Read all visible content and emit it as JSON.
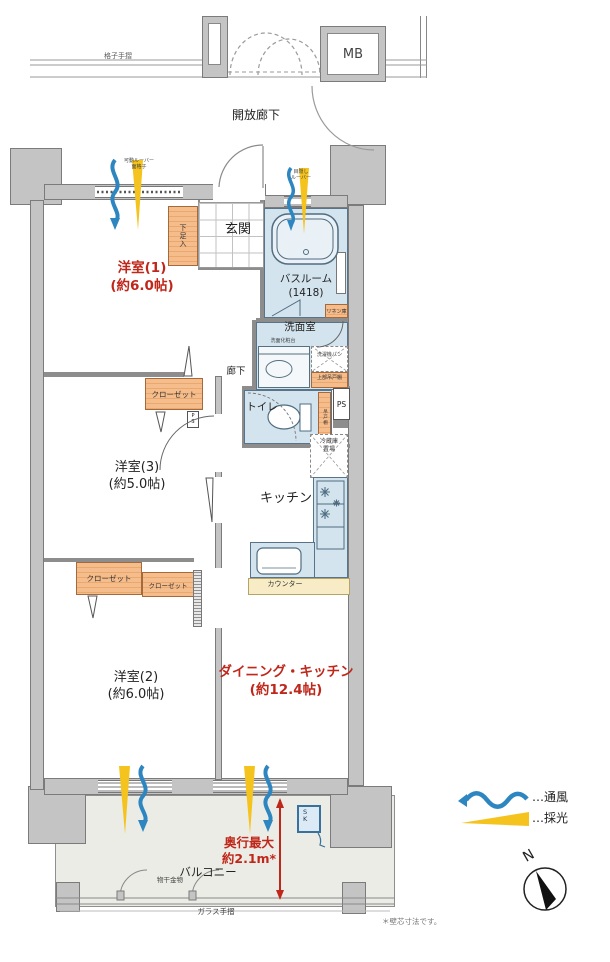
{
  "colors": {
    "wall_gray": "#c4c4c4",
    "wet_blue": "#d3e4ee",
    "cabinet_orange": "#f5bc8c",
    "counter_cream": "#f7ecc6",
    "accent_red": "#c0271b",
    "ventilation_blue": "#2e86c1",
    "daylight_yellow": "#f5c31d"
  },
  "corridor": {
    "handrail": "格子手摺",
    "open_corridor": "開放廊下",
    "meter_box": "MB"
  },
  "rooms": {
    "western1": {
      "name": "洋室(1)",
      "size": "(約6.0帖)"
    },
    "western3": {
      "name": "洋室(3)",
      "size": "(約5.0帖)"
    },
    "western2": {
      "name": "洋室(2)",
      "size": "(約6.0帖)"
    },
    "dining_kitchen": {
      "name": "ダイニング・キッチン",
      "size": "(約12.4帖)"
    },
    "entrance": "玄関",
    "shoe_box": "下足入",
    "bathroom": {
      "name": "バスルーム",
      "size": "(1418)"
    },
    "washroom": "洗面室",
    "vanity": "洗面化粧台",
    "washer_pan": "洗濯機パン",
    "upper_cabinet": "上部吊戸棚",
    "linen": "リネン庫",
    "hallway": "廊下",
    "toilet": "トイレ",
    "toilet_shelf": "吊戸棚",
    "pipe_space": "PS",
    "fridge": {
      "line1": "冷蔵庫",
      "line2": "置場"
    },
    "closet": "クローゼット",
    "kitchen": "キッチン",
    "counter": "カウンター"
  },
  "balcony": {
    "name": "バルコニー",
    "depth": {
      "line1": "奥行最大",
      "line2": "約2.1m*"
    },
    "laundry_fitting": "物干金物",
    "glass_rail": "ガラス手摺",
    "slop_sink": "SK"
  },
  "window_notes": {
    "bedroom": {
      "line1": "可動ルーバー",
      "line2": "面格子"
    },
    "bath": {
      "line1": "目隠し",
      "line2": "ルーバー"
    }
  },
  "legend": {
    "ventilation": "…通風",
    "daylight": "…採光",
    "north": "N"
  },
  "footnote": "＊壁芯寸法です。"
}
